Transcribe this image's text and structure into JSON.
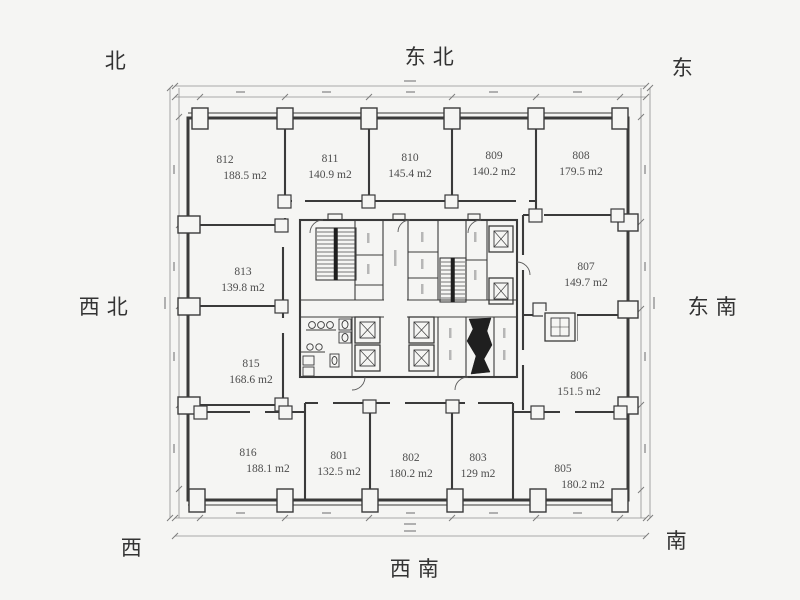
{
  "compass": {
    "north": "北",
    "northeast": "东北",
    "east": "东",
    "northwest": "西北",
    "southeast": "东南",
    "west": "西",
    "southwest": "西南",
    "south": "南"
  },
  "rooms": [
    {
      "number": "812",
      "area": "188.5 m2"
    },
    {
      "number": "811",
      "area": "140.9 m2"
    },
    {
      "number": "810",
      "area": "145.4 m2"
    },
    {
      "number": "809",
      "area": "140.2 m2"
    },
    {
      "number": "808",
      "area": "179.5 m2"
    },
    {
      "number": "813",
      "area": "139.8 m2"
    },
    {
      "number": "807",
      "area": "149.7 m2"
    },
    {
      "number": "815",
      "area": "168.6 m2"
    },
    {
      "number": "806",
      "area": "151.5 m2"
    },
    {
      "number": "816",
      "area": "188.1 m2"
    },
    {
      "number": "801",
      "area": "132.5 m2"
    },
    {
      "number": "802",
      "area": "180.2 m2"
    },
    {
      "number": "803",
      "area": "129 m2"
    },
    {
      "number": "805",
      "area": "180.2 m2"
    }
  ],
  "colors": {
    "background": "#f5f5f3",
    "wall_line": "#3a3a3a",
    "dimension_line": "#8f8f8f",
    "label_text": "#4d4d4d"
  }
}
